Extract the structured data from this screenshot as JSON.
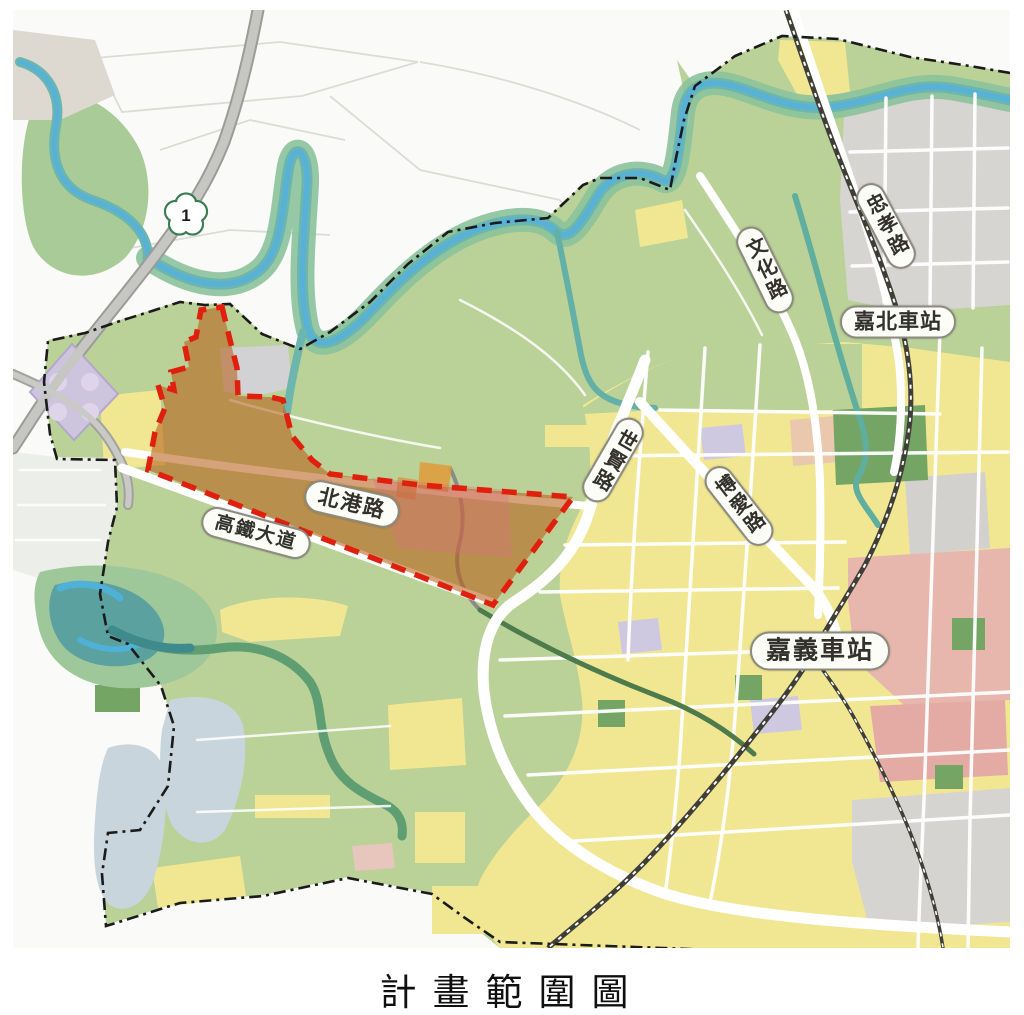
{
  "figure": {
    "caption": "計畫範圍圖"
  },
  "map": {
    "highway_shield": {
      "number": "1"
    },
    "road_labels": {
      "beigang": "北港路",
      "hsr_boulevard": "高鐵大道",
      "shixian": "世賢路",
      "boai": "博愛路",
      "wenhua": "文化路",
      "zhongxiao": "忠孝路"
    },
    "station_labels": {
      "jiabei": "嘉北車站",
      "chiayi": "嘉義車站"
    },
    "colors": {
      "plan_area_stroke": "#e0200e",
      "plan_area_fill": "#b95f19",
      "district_boundary": "#1b1b1b",
      "farmland_green": "#bad197",
      "urban_yellow": "#f1e793",
      "river_blue": "#58b1d6",
      "commercial_pink": "#e7b6ad"
    }
  }
}
